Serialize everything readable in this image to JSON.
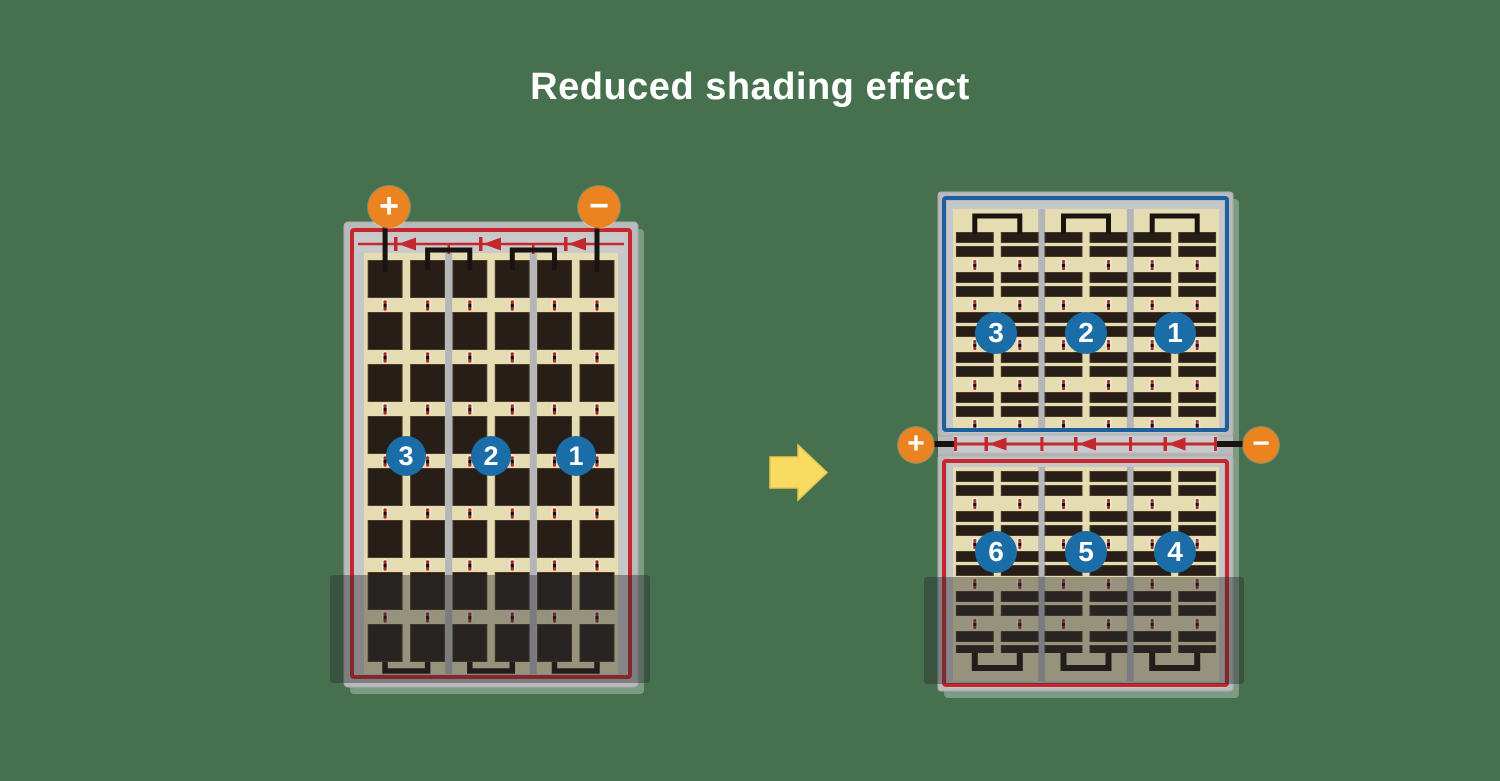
{
  "title": "Reduced shading effect",
  "colors": {
    "background": "#46704e",
    "panel_frame": "#b9babc",
    "wire_red": "#c4272c",
    "wire_blue": "#1d5f9f",
    "backsheet_cream": "#e6dcb2",
    "cell_dark": "#271f17",
    "terminal_orange": "#ea8320",
    "badge_blue": "#1a6da7",
    "arrow_yellow": "#f8db60",
    "shade_overlay": "rgba(44,44,48,0.42)"
  },
  "left_panel": {
    "terminals": {
      "positive": "+",
      "negative": "−"
    },
    "strings": [
      "3",
      "2",
      "1"
    ]
  },
  "right_panel": {
    "terminals": {
      "positive": "+",
      "negative": "−"
    },
    "top_strings": [
      "3",
      "2",
      "1"
    ],
    "bottom_strings": [
      "6",
      "5",
      "4"
    ]
  }
}
